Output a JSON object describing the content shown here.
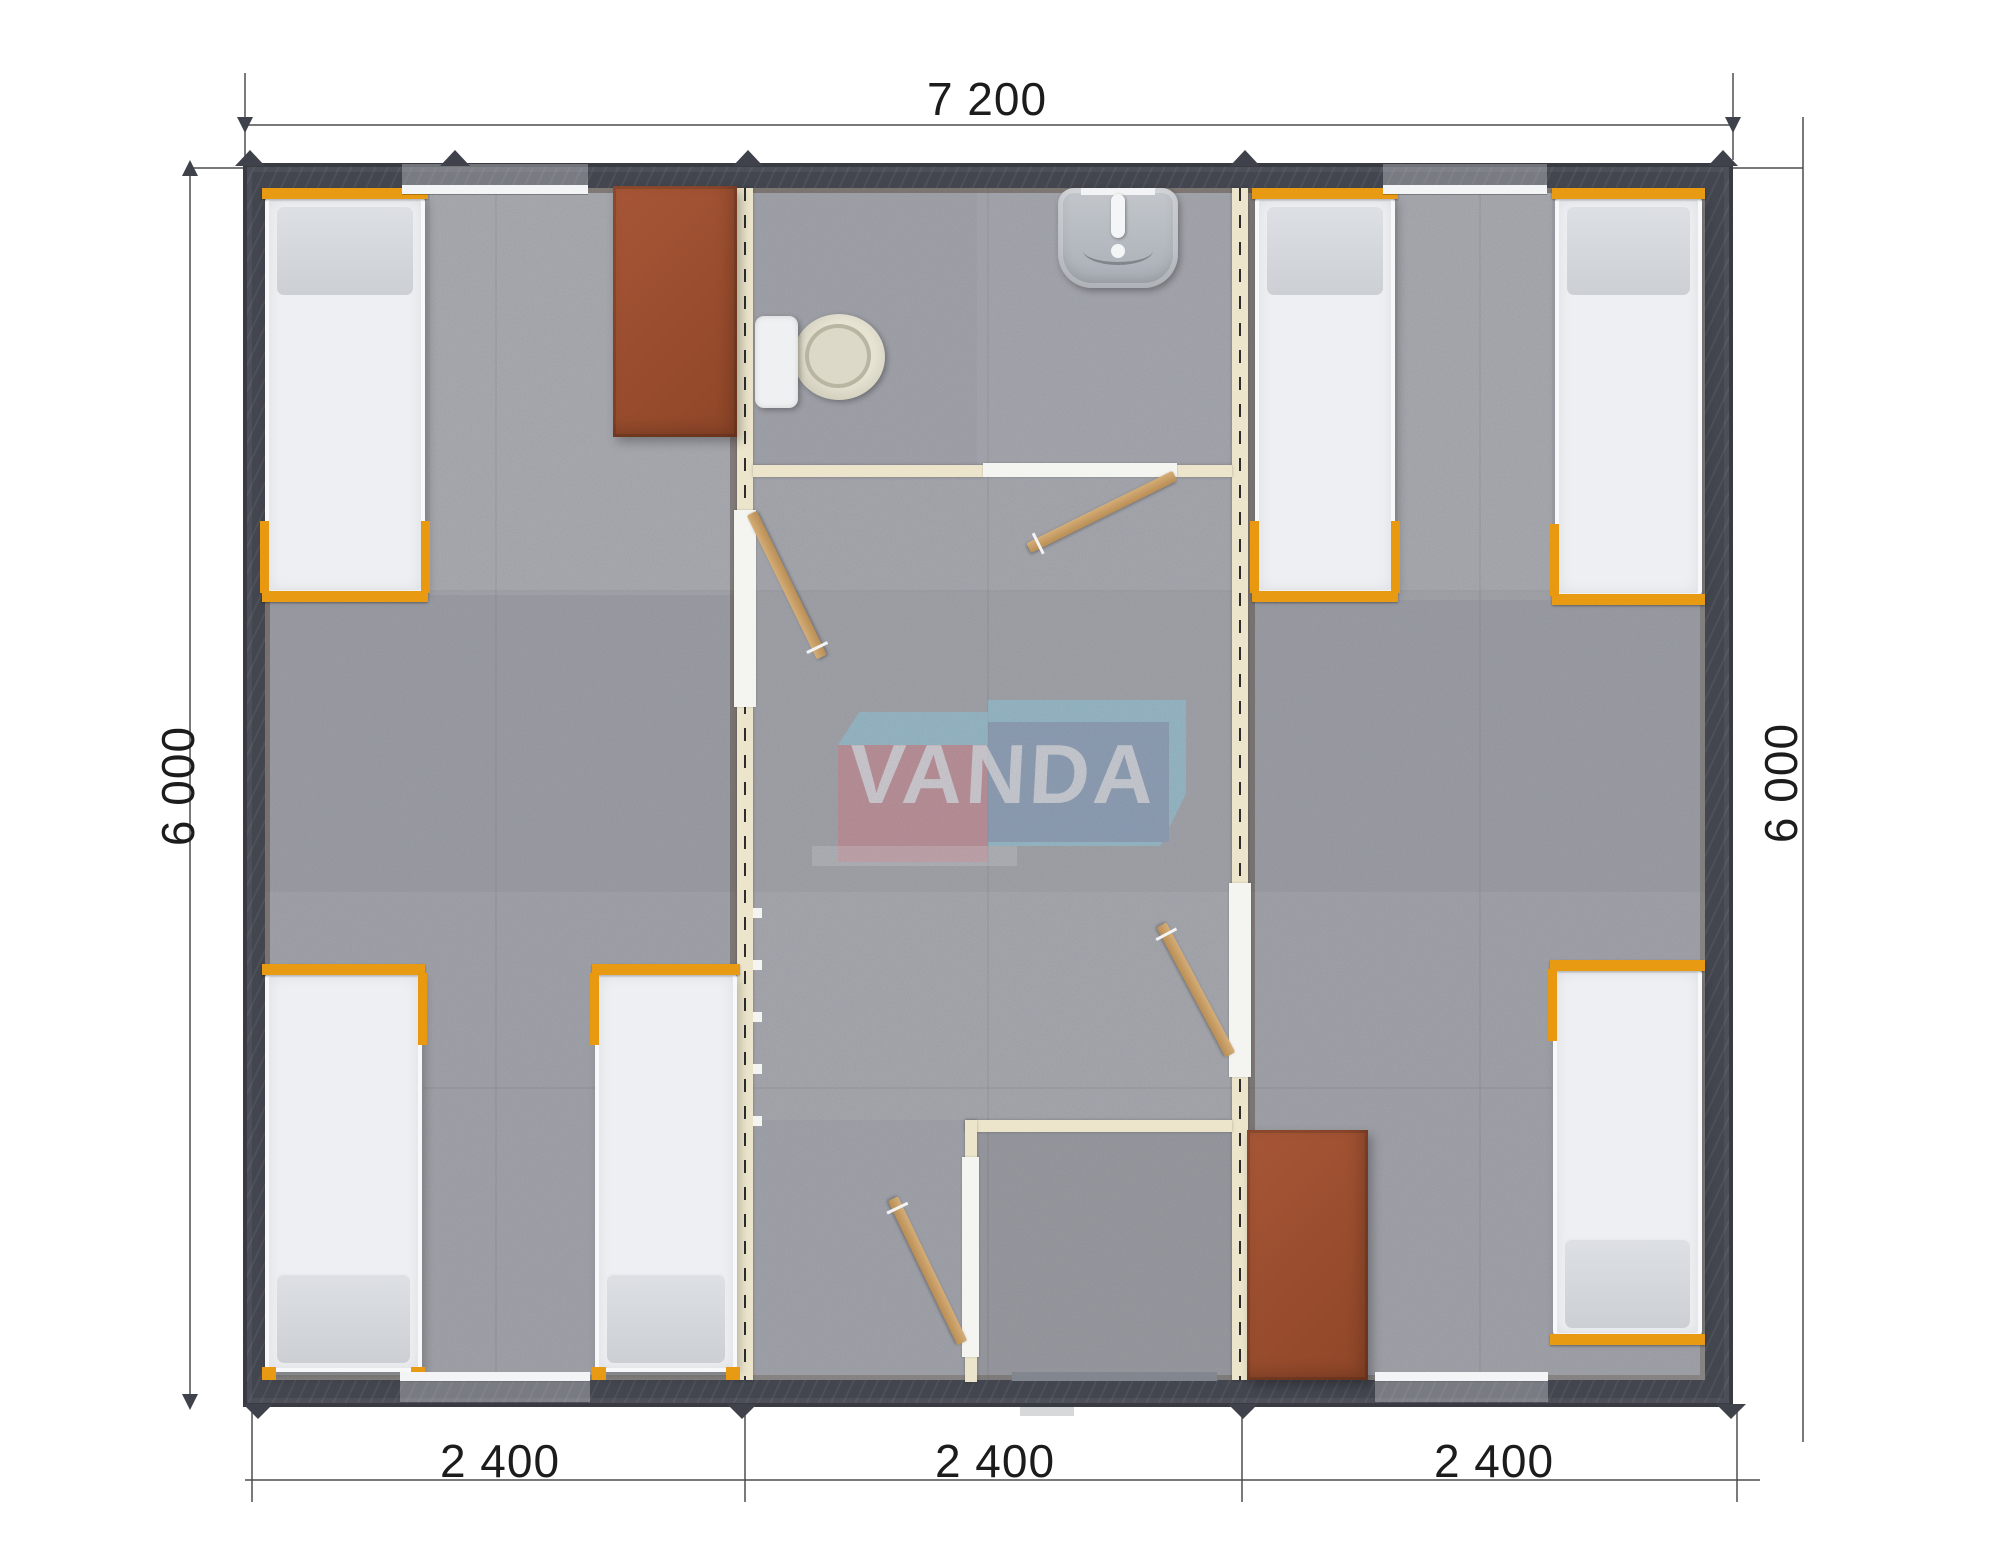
{
  "watermark": {
    "text": "VANDA",
    "pink": "#cf7f8a",
    "blue": "#7e9abd",
    "light_blue": "#8ecade",
    "text_color": "#f6fafd"
  },
  "dimensions": {
    "top_width": "7 200",
    "left_height": "6 000",
    "right_height": "6 000",
    "bottom_modules": [
      "2 400",
      "2 400",
      "2 400"
    ]
  },
  "elements": {
    "beds": 6,
    "desks": 2,
    "toilets": 1,
    "sinks": 1,
    "showers": 1,
    "interior_doors": 4,
    "windows": 4
  },
  "colors": {
    "exterior_wall": "#43464e",
    "floor": "#a2a4ab",
    "partition": "#ece5cb",
    "door_leaf": "#c9a368",
    "bed_frame": "#e89b12",
    "mattress": "#edeff2",
    "pillow": "#d6d9dd",
    "desk": "#9d5131",
    "toilet_bowl": "#d9d6c5",
    "sink": "#b6bac0",
    "dimension_text": "#1c1c1c"
  }
}
